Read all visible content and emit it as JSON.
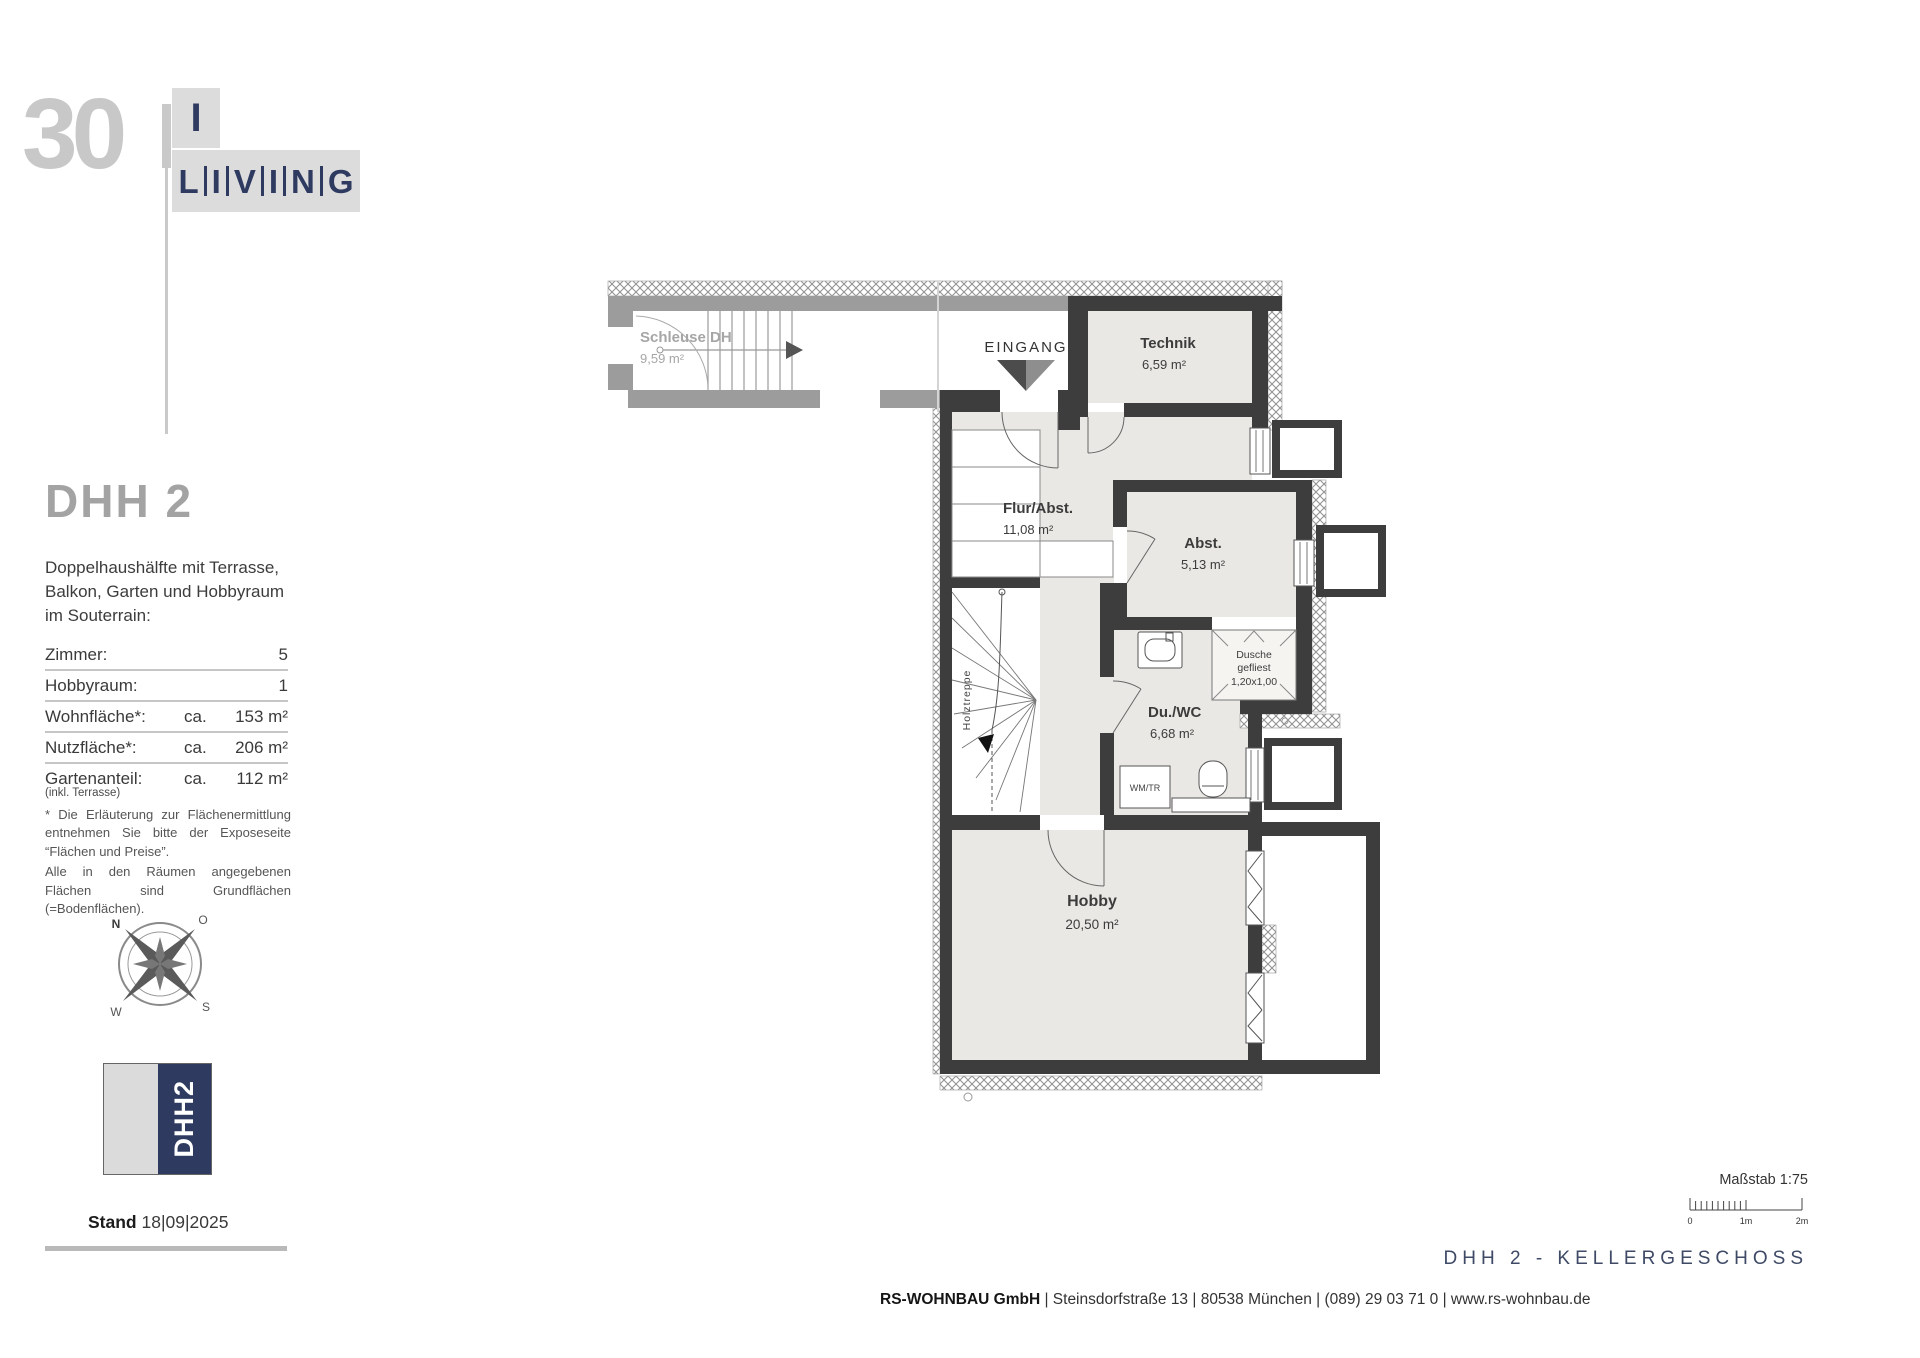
{
  "logo": {
    "number": "30",
    "i": "I",
    "letters": [
      "L",
      "I",
      "V",
      "I",
      "N",
      "G"
    ]
  },
  "sidebar": {
    "title": "DHH 2",
    "description": "Doppelhaushälfte mit Terrasse, Balkon, Garten und Hobbyraum im Souterrain:",
    "specs": [
      {
        "label": "Zimmer:",
        "prefix": "",
        "value": "5"
      },
      {
        "label": "Hobbyraum:",
        "prefix": "",
        "value": "1"
      },
      {
        "label": "Wohnfläche*:",
        "prefix": "ca.",
        "value": "153 m²"
      },
      {
        "label": "Nutzfläche*:",
        "prefix": "ca.",
        "value": "206 m²"
      },
      {
        "label": "Gartenanteil:",
        "sub": "(inkl. Terrasse)",
        "prefix": "ca.",
        "value": "112 m²"
      }
    ],
    "footnote1": "* Die Erläuterung zur Flächenermittlung entnehmen Sie bitte der Exposeseite “Flächen und Preise”.",
    "footnote2": "Alle in den Räumen angegebenen Flächen sind Grundflächen (=Bodenflächen).",
    "compass": {
      "n": "N",
      "o": "O",
      "s": "S",
      "w": "W"
    },
    "badge": "DHH2",
    "stand_label": "Stand",
    "stand_date": "18|09|2025"
  },
  "plan": {
    "labels": {
      "schleuse": "Schleuse DH",
      "schleuse_area": "9,59 m²",
      "eingang": "EINGANG",
      "technik": "Technik",
      "technik_area": "6,59 m²",
      "flur": "Flur/Abst.",
      "flur_area": "11,08 m²",
      "abst": "Abst.",
      "abst_area": "5,13 m²",
      "dusche1": "Dusche",
      "dusche2": "gefliest",
      "dusche3": "1,20x1,00",
      "duwc": "Du./WC",
      "duwc_area": "6,68 m²",
      "wmtr": "WM/TR",
      "hobby": "Hobby",
      "hobby_area": "20,50 m²",
      "holztreppe": "Holztreppe"
    }
  },
  "footer": {
    "scale_label": "Maßstab 1:75",
    "scale_ticks": [
      "0",
      "1m",
      "2m"
    ],
    "plan_title": "DHH 2 - KELLERGESCHOSS",
    "company": "RS-WOHNBAU GmbH",
    "address": " | Steinsdorfstraße 13 |  80538 München | (089) 29 03 71 0 | www.rs-wohnbau.de"
  },
  "colors": {
    "wall_dark": "#3d3d3d",
    "wall_gray": "#9c9c9c",
    "floor": "#eae8e5",
    "navy": "#2e3a60",
    "logo_gray": "#c8c8c8"
  }
}
